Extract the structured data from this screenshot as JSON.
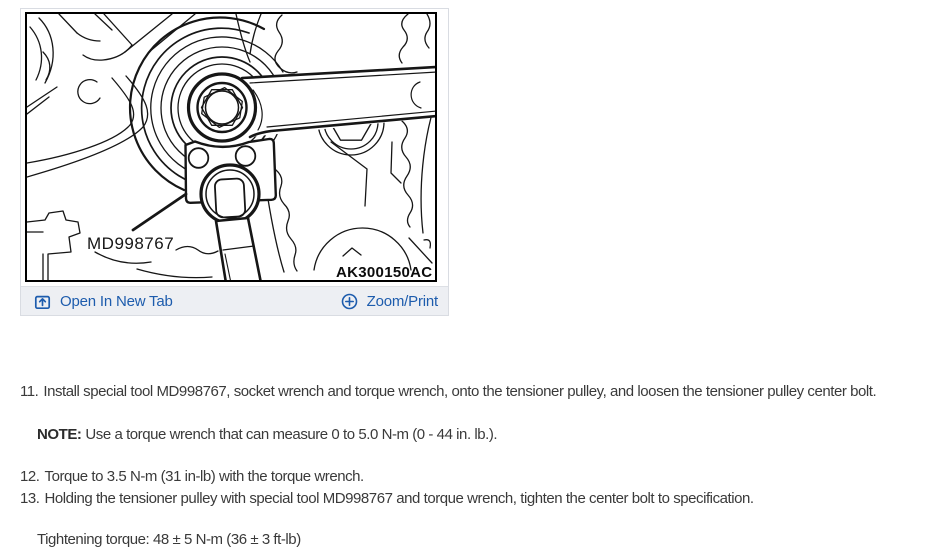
{
  "colors": {
    "link_blue": "#1d5cad",
    "body_text": "#3a3a3a",
    "bar_background": "#edeff3",
    "frame_border": "#000000"
  },
  "card": {
    "diagram": {
      "tool_label": "MD998767",
      "figure_code": "AK300150AC"
    },
    "footer": {
      "open_link": {
        "label": "Open In New Tab",
        "icon": "open-in-new-tab-icon"
      },
      "zoom_link": {
        "label": "Zoom/Print",
        "icon": "circle-plus-icon"
      }
    }
  },
  "instructions": {
    "steps": [
      {
        "num": "11.",
        "text": "Install special tool MD998767, socket wrench and torque wrench, onto the tensioner pulley, and loosen the tensioner pulley center bolt."
      },
      {
        "num": "12.",
        "text": "Torque to 3.5 N-m (31 in-lb) with the torque wrench."
      },
      {
        "num": "13.",
        "text": "Holding the tensioner pulley with special tool MD998767 and torque wrench, tighten the center bolt to specification."
      }
    ],
    "note": {
      "label": "NOTE:",
      "text": "Use a torque wrench that can measure 0 to 5.0 N-m (0 - 44 in. lb.)."
    },
    "torque_spec": "Tightening torque: 48 ± 5 N-m (36 ± 3 ft-lb)"
  }
}
